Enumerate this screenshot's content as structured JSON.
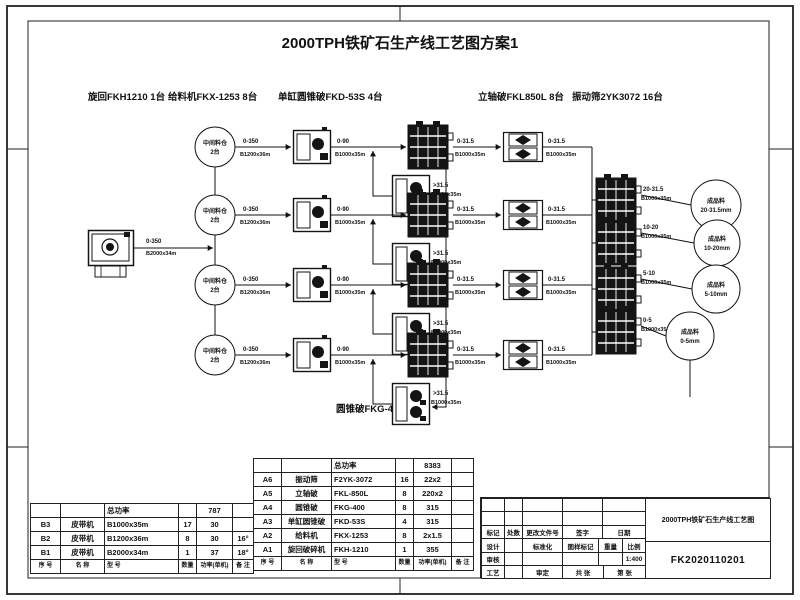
{
  "colors": {
    "ink": "#111111"
  },
  "sheet": {
    "title": "2000TPH铁矿石生产线工艺图方案1"
  },
  "legend": {
    "gyratory": "旋回FKH1210 1台",
    "feeder": "给料机FKX-1253 8台",
    "single_cone": "单缸圆锥破FKD-53S 4台",
    "vsi": "立轴破FKL850L 8台",
    "screen": "振动筛2YK3072 16台",
    "cone": "圆锥破FKG-400 8台"
  },
  "flow": {
    "feed": {
      "size": "0-350",
      "belt": "B2000x34m"
    },
    "bin": {
      "name": "中间料仓",
      "count": "2台"
    },
    "row": {
      "bin_out_size": "0-350",
      "bin_out_belt": "B1200x36m",
      "fkd_out_size": "0-90",
      "fkd_out_belt": "B1000x35m",
      "oversize_size": ">31.5",
      "oversize_belt": "B1000x35m",
      "screen_out_size": "0-31.5",
      "screen_out_belt": "B1000x35m",
      "vsi_out_size": "0-31.5",
      "vsi_out_belt": "B1000x35m"
    },
    "products": [
      {
        "size": "20-31.5",
        "belt": "B1000x35m",
        "name": "成品料",
        "range": "20-31.5mm"
      },
      {
        "size": "10-20",
        "belt": "B1000x35m",
        "name": "成品料",
        "range": "10-20mm"
      },
      {
        "size": "5-10",
        "belt": "B1000x35m",
        "name": "成品料",
        "range": "5-10mm"
      },
      {
        "size": "0-5",
        "belt": "B1000x35m",
        "name": "成品料",
        "range": "0-5mm"
      }
    ]
  },
  "belt_table": {
    "rows": [
      [
        "",
        "",
        "总功率",
        "",
        "787",
        ""
      ],
      [
        "B3",
        "皮带机",
        "B1000x35m",
        "17",
        "30",
        ""
      ],
      [
        "B2",
        "皮带机",
        "B1200x36m",
        "8",
        "30",
        "16°"
      ],
      [
        "B1",
        "皮带机",
        "B2000x34m",
        "1",
        "37",
        "18°"
      ],
      [
        "序 号",
        "名 称",
        "型 号",
        "数量",
        "功率(单机)",
        "备 注"
      ]
    ]
  },
  "equipment_table": {
    "rows": [
      [
        "",
        "",
        "总功率",
        "",
        "8383",
        ""
      ],
      [
        "A6",
        "振动筛",
        "F2YK-3072",
        "16",
        "22x2",
        ""
      ],
      [
        "A5",
        "立轴破",
        "FKL-850L",
        "8",
        "220x2",
        ""
      ],
      [
        "A4",
        "圆锥破",
        "FKG-400",
        "8",
        "315",
        ""
      ],
      [
        "A3",
        "单缸圆锥破",
        "FKD-53S",
        "4",
        "315",
        ""
      ],
      [
        "A2",
        "给料机",
        "FKX-1253",
        "8",
        "2x1.5",
        ""
      ],
      [
        "A1",
        "旋回破碎机",
        "FKH-1210",
        "1",
        "355",
        ""
      ],
      [
        "序 号",
        "名 称",
        "型 号",
        "数量",
        "功率(单机)",
        "备 注"
      ]
    ]
  },
  "titleblock": {
    "drawing_title": "2000TPH铁矿石生产线工艺图",
    "drawing_no": "FK2020110201",
    "scale_value": "1:400",
    "labels": {
      "mark": "标记",
      "qty": "处数",
      "change_doc": "更改文件号",
      "sign": "签字",
      "date": "日期",
      "design": "设计",
      "standard": "标准化",
      "stamp": "图样标记",
      "weight": "重量",
      "scale": "比例",
      "check": "审核",
      "process": "工艺",
      "approve": "审定",
      "total_sheet": "共  张",
      "sheet": "第  张"
    }
  }
}
